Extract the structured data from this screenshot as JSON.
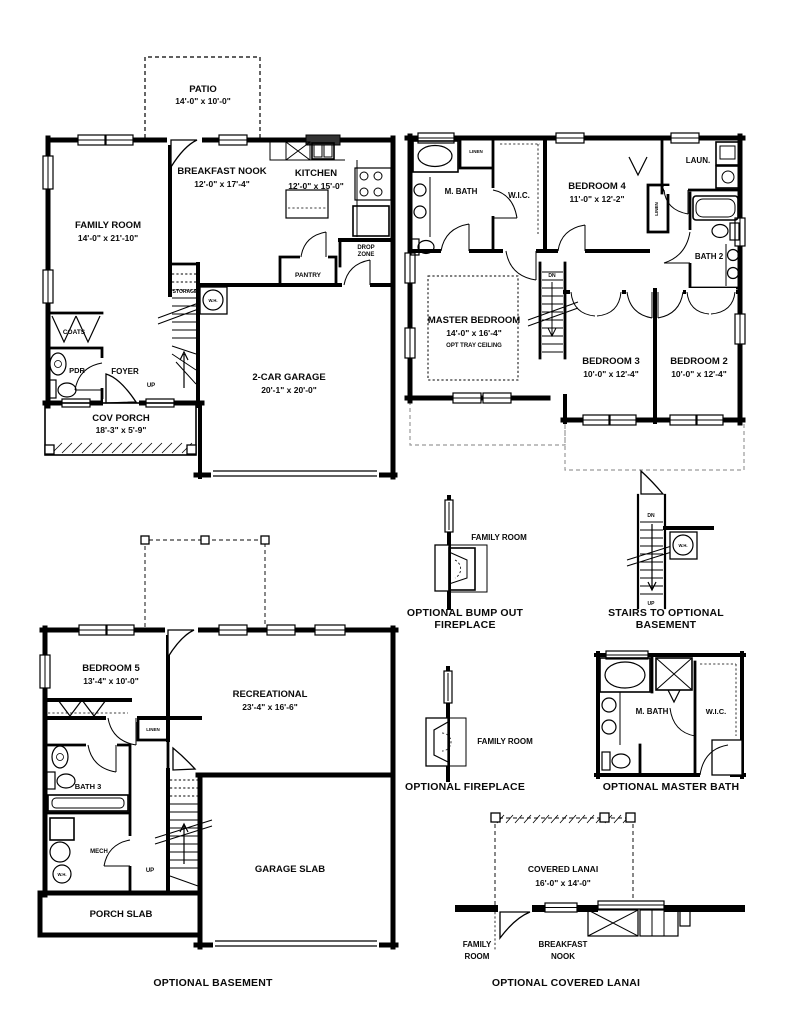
{
  "first_floor": {
    "patio": {
      "name": "PATIO",
      "dims": "14'-0\" x 10'-0\""
    },
    "breakfast_nook": {
      "name": "BREAKFAST NOOK",
      "dims": "12'-0\" x 17'-4\""
    },
    "kitchen": {
      "name": "KITCHEN",
      "dims": "12'-0\" x 15'-0\""
    },
    "family_room": {
      "name": "FAMILY ROOM",
      "dims": "14'-0\" x 21'-10\""
    },
    "garage": {
      "name": "2-CAR GARAGE",
      "dims": "20'-1\" x 20'-0\""
    },
    "cov_porch": {
      "name": "COV PORCH",
      "dims": "18'-3\" x 5'-9\""
    },
    "foyer": "FOYER",
    "pdr": "PDR",
    "coats": "COATS",
    "pantry": "PANTRY",
    "drop_zone_line1": "DROP",
    "drop_zone_line2": "ZONE",
    "storage": "STORAGE",
    "water_heater": "W.H.",
    "up": "UP"
  },
  "second_floor": {
    "m_bath": "M. BATH",
    "wic": "W.I.C.",
    "bedroom4": {
      "name": "BEDROOM 4",
      "dims": "11'-0\" x 12'-2\""
    },
    "laundry": "LAUN.",
    "bath2": "BATH 2",
    "linen_top": "LINEN",
    "linen_side": "LINEN",
    "dn": "DN",
    "master": {
      "name": "MASTER BEDROOM",
      "dims": "14'-0\" x 16'-4\"",
      "note": "OPT TRAY CEILING"
    },
    "bedroom3": {
      "name": "BEDROOM 3",
      "dims": "10'-0\" x 12'-4\""
    },
    "bedroom2": {
      "name": "BEDROOM 2",
      "dims": "10'-0\" x 12'-4\""
    }
  },
  "basement": {
    "bedroom5": {
      "name": "BEDROOM 5",
      "dims": "13'-4\" x 10'-0\""
    },
    "recreational": {
      "name": "RECREATIONAL",
      "dims": "23'-4\" x 16'-6\""
    },
    "linen": "LINEN",
    "bath3": "BATH 3",
    "mech": "MECH",
    "water_heater": "W.H.",
    "up": "UP",
    "porch_slab": "PORCH SLAB",
    "garage_slab": "GARAGE SLAB",
    "caption": "OPTIONAL BASEMENT"
  },
  "details": {
    "bump_out": {
      "family_room": "FAMILY ROOM",
      "caption_line1": "OPTIONAL BUMP OUT",
      "caption_line2": "FIREPLACE"
    },
    "stairs": {
      "dn": "DN",
      "up": "UP",
      "water_heater": "W.H.",
      "caption_line1": "STAIRS TO OPTIONAL",
      "caption_line2": "BASEMENT"
    },
    "fireplace": {
      "family_room": "FAMILY ROOM",
      "caption": "OPTIONAL FIREPLACE"
    },
    "master_bath": {
      "m_bath": "M. BATH",
      "wic": "W.I.C.",
      "caption": "OPTIONAL MASTER BATH"
    },
    "lanai": {
      "name": "COVERED LANAI",
      "dims": "16'-0\" x 14'-0\"",
      "family_line1": "FAMILY",
      "family_line2": "ROOM",
      "nook_line1": "BREAKFAST",
      "nook_line2": "NOOK",
      "caption": "OPTIONAL COVERED LANAI"
    }
  }
}
